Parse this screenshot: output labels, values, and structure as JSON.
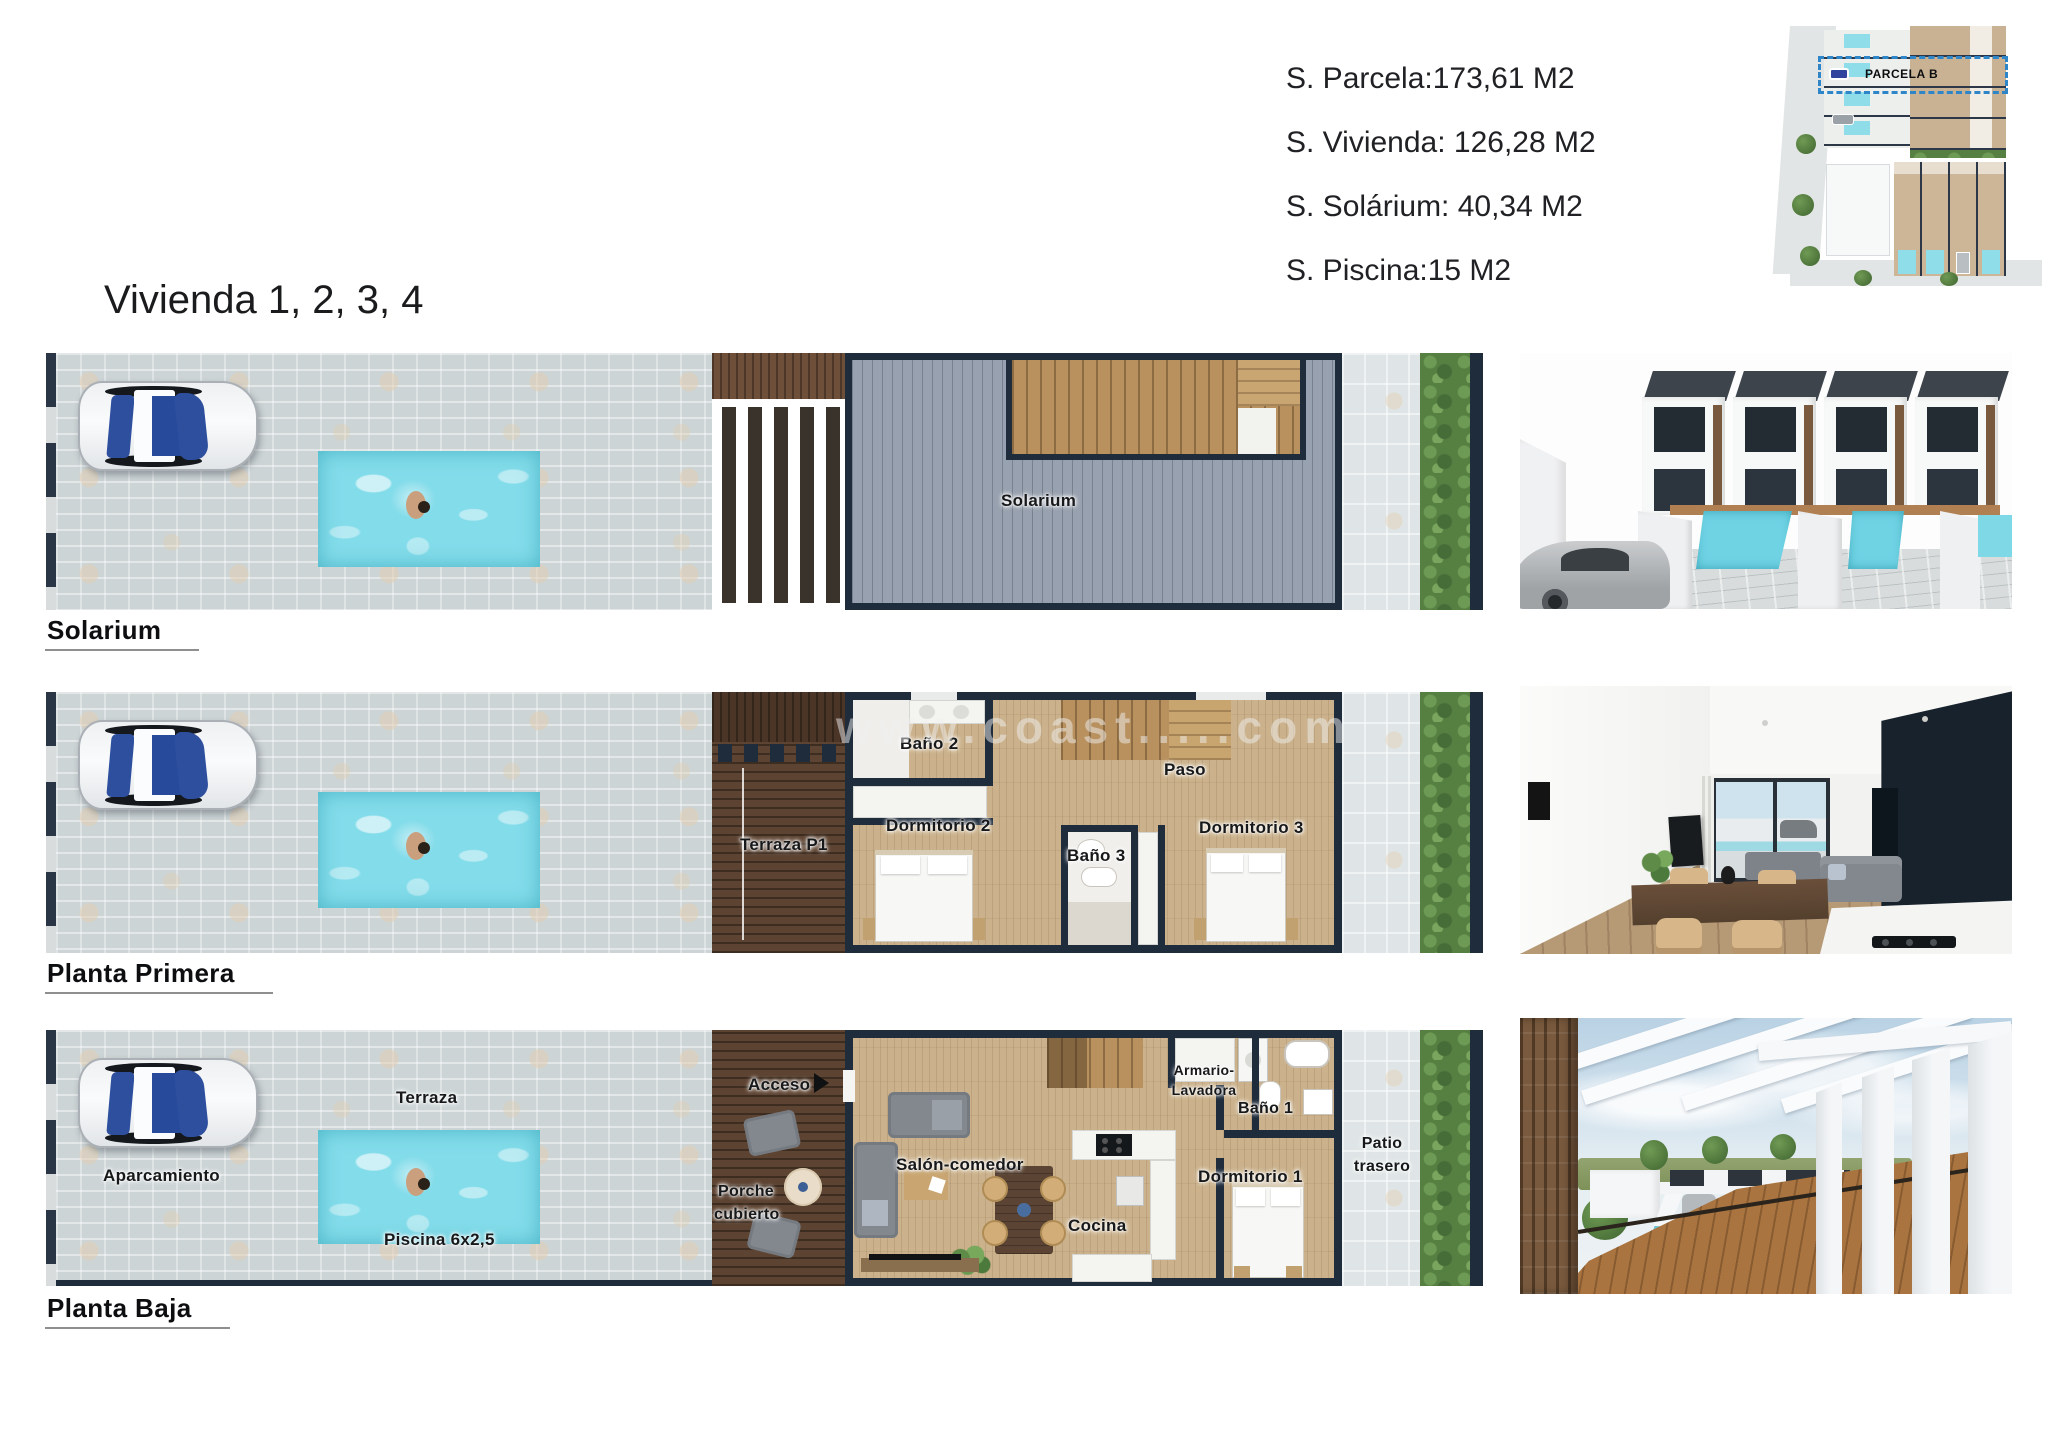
{
  "title": "Vivienda 1, 2, 3, 4",
  "header": {
    "stats": [
      "S. Parcela:173,61 M2",
      "S. Vivienda: 126,28 M2",
      "S. Solárium: 40,34 M2",
      "S. Piscina:15 M2"
    ]
  },
  "site_plan": {
    "parcel_label": "PARCELA B"
  },
  "floors": [
    {
      "label": "Solarium",
      "rooms": {
        "solarium": "Solarium"
      }
    },
    {
      "label": "Planta Primera",
      "watermark": "www.coast.....com",
      "rooms": {
        "bano2": "Baño 2",
        "paso": "Paso",
        "dormitorio2": "Dormitorio 2",
        "bano3": "Baño 3",
        "dormitorio3": "Dormitorio 3",
        "terraza_p1": "Terraza P1"
      }
    },
    {
      "label": "Planta Baja",
      "rooms": {
        "aparcamiento": "Aparcamiento",
        "terraza": "Terraza",
        "piscina": "Piscina 6x2,5",
        "acceso": "Acceso",
        "porche_l1": "Porche",
        "porche_l2": "cubierto",
        "salon": "Salón-comedor",
        "cocina": "Cocina",
        "armario_l1": "Armario-",
        "armario_l2": "Lavadora",
        "bano1": "Baño 1",
        "dormitorio1": "Dormitorio 1",
        "patio_l1": "Patio",
        "patio_l2": "trasero"
      }
    }
  ],
  "colors": {
    "wall_navy": "#1f2c3c",
    "pool_water": "#83dcea",
    "paver_gray": "#ccd4d6",
    "solarium_deck": "#98a1af",
    "wood_floor": "#cbb28c",
    "wood_terrace_dark": "#5d4331",
    "hedge_green": "#567f42",
    "parcel_dashed_blue": "#2e86c8"
  }
}
